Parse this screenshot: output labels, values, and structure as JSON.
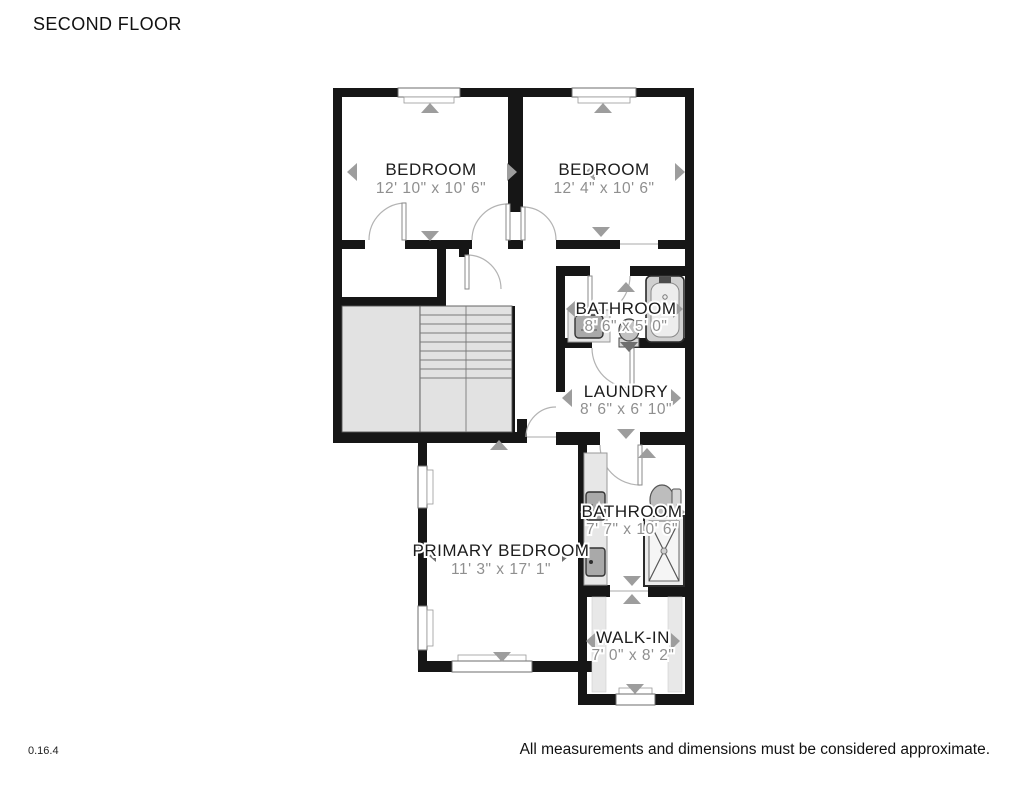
{
  "title": "SECOND FLOOR",
  "footer": {
    "version": "0.16.4",
    "disclaimer": "All measurements and dimensions must be considered approximate."
  },
  "rooms": {
    "bedroom_left": {
      "name": "BEDROOM",
      "dims": "12' 10\" x 10' 6\""
    },
    "bedroom_right": {
      "name": "BEDROOM",
      "dims": "12' 4\" x 10' 6\""
    },
    "bathroom_hall": {
      "name": "BATHROOM",
      "dims": "8' 6\" x 5' 0\""
    },
    "laundry": {
      "name": "LAUNDRY",
      "dims": "8' 6\" x 6' 10\""
    },
    "primary_bedroom": {
      "name": "PRIMARY BEDROOM",
      "dims": "11' 3\" x 17' 1\""
    },
    "bathroom_primary": {
      "name": "BATHROOM",
      "dims": "7' 7\" x 10' 6\""
    },
    "walk_in": {
      "name": "WALK-IN",
      "dims": "7' 0\" x 8' 2\""
    }
  },
  "colors": {
    "wall": "#161616",
    "stair_fill": "#e2e2e2",
    "fixture_dark": "#a9a9a9",
    "nav_arrow": "#9d9d9d",
    "room_name_text": "#1c1c1c",
    "dimension_text": "#8f8f8f"
  }
}
